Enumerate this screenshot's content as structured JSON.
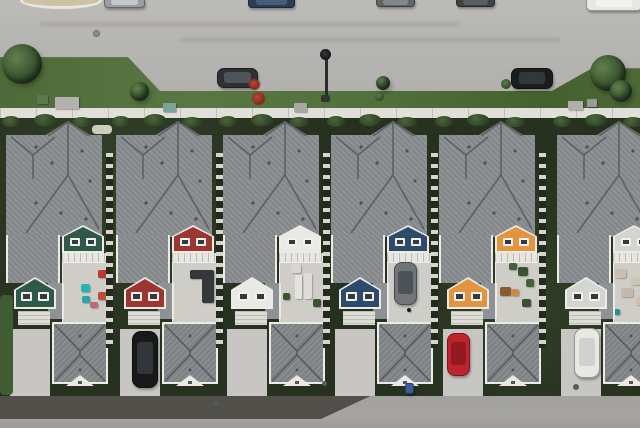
{
  "scene": {
    "description": "Aerial drone photo of six attached townhouses: gray shingle roofs, colored rear gables (green, red, white, blue, orange, gray), rear patios, detached garage roofs, concrete driveways and a back lane at bottom; a curved street with parked cars, grass verge, trees and a sidewalk at top."
  },
  "palette": {
    "street": "#b5b4b1",
    "street_light": "#bcbbb8",
    "sidewalk": "#e0dfda",
    "grass": "#567440",
    "veg": "#27311f",
    "veg_blob": "#2e4026",
    "veg_light": "#4a6638",
    "roof": "#8a8d8f",
    "roof_ridge": "#565a5c",
    "roof_trim": "#ecebe6",
    "garage_roof": "#84878a",
    "patio": "#cfcdc8",
    "deck": "#e7e5e0",
    "driveway": "#c7c6c2",
    "apron": "#c3c2be",
    "lane": "#a6a5a2",
    "lane_dark": "#504f4a",
    "island": "#cdc2a6",
    "window": "#333a3e",
    "win_frame": "#f2f1ed",
    "stone_light": "#d6d5cf",
    "stone_dark": "#222a1c"
  },
  "street": {
    "island": {
      "x": 20,
      "y": -8,
      "w": 82,
      "h": 17
    },
    "manhole": {
      "x": 93,
      "y": 30,
      "d": 7
    },
    "lamp": {
      "head_x": 320,
      "head_y": 49,
      "head_d": 11,
      "pole_x": 325,
      "pole_y": 57,
      "pole_h": 41,
      "base_x": 321,
      "base_y": 95
    },
    "red_shrub": [
      {
        "x": 249,
        "y": 79,
        "d": 11
      },
      {
        "x": 252,
        "y": 92,
        "d": 13
      }
    ],
    "curb_bushes": [
      {
        "x": 501,
        "y": 79,
        "d": 10
      },
      {
        "x": 375,
        "y": 92,
        "d": 9
      }
    ]
  },
  "verge": {
    "trees": [
      {
        "x": 2,
        "y": 44,
        "d": 40
      },
      {
        "x": 130,
        "y": 82,
        "d": 19
      },
      {
        "x": 590,
        "y": 55,
        "d": 36
      },
      {
        "x": 376,
        "y": 76,
        "d": 14
      },
      {
        "x": 610,
        "y": 80,
        "d": 22
      }
    ],
    "boxes": [
      {
        "x": 37,
        "y": 95,
        "w": 11,
        "h": 9,
        "c": "#5a7a4e"
      },
      {
        "x": 55,
        "y": 97,
        "w": 24,
        "h": 12,
        "c": "#b3b2ae"
      },
      {
        "x": 163,
        "y": 103,
        "w": 13,
        "h": 9,
        "c": "#79a49a"
      },
      {
        "x": 294,
        "y": 103,
        "w": 13,
        "h": 9,
        "c": "#a9a8a4"
      },
      {
        "x": 568,
        "y": 101,
        "w": 15,
        "h": 9,
        "c": "#b0afab"
      },
      {
        "x": 587,
        "y": 99,
        "w": 10,
        "h": 8,
        "c": "#9a9995"
      }
    ]
  },
  "houses": [
    {
      "name": "house-1-green",
      "x": 0,
      "facade": "#2e5847",
      "furniture": [
        {
          "x": 18,
          "y": 21,
          "w": 9,
          "h": 8,
          "c": "#2ab4ae"
        },
        {
          "x": 19,
          "y": 33,
          "w": 8,
          "h": 7,
          "c": "#2aa6a8"
        },
        {
          "x": 35,
          "y": 7,
          "w": 10,
          "h": 8,
          "c": "#b83a30"
        },
        {
          "x": 35,
          "y": 29,
          "w": 9,
          "h": 8,
          "c": "#bf4a40"
        },
        {
          "x": 27,
          "y": 39,
          "w": 8,
          "h": 6,
          "c": "#c06a70"
        }
      ],
      "extras": [
        {
          "x": 92,
          "y": 12,
          "w": 20,
          "h": 9,
          "c": "#c9cfbc"
        },
        {
          "x": 0,
          "y": 182,
          "w": 13,
          "h": 100,
          "c": "#3f5c32"
        }
      ]
    },
    {
      "name": "house-2-red",
      "x": 110,
      "facade": "#9c3631",
      "furniture": [
        {
          "x": 17,
          "y": 7,
          "w": 24,
          "h": 9,
          "c": "#35383a"
        },
        {
          "x": 29,
          "y": 14,
          "w": 12,
          "h": 26,
          "c": "#35383a"
        }
      ],
      "extras": []
    },
    {
      "name": "house-3-white",
      "x": 217,
      "facade": "#e9e9e5",
      "furniture": [
        {
          "x": 15,
          "y": 12,
          "w": 7,
          "h": 24,
          "c": "#e4e3de"
        },
        {
          "x": 24,
          "y": 10,
          "w": 8,
          "h": 26,
          "c": "#dddcd7"
        },
        {
          "x": 11,
          "y": 1,
          "w": 10,
          "h": 9,
          "c": "#d8d7d2"
        },
        {
          "x": 33,
          "y": 36,
          "w": 8,
          "h": 8,
          "c": "#3c5531"
        },
        {
          "x": 3,
          "y": 30,
          "w": 7,
          "h": 7,
          "c": "#3c5531"
        }
      ],
      "extras": []
    },
    {
      "name": "house-4-blue",
      "x": 325,
      "facade": "#2c4a69",
      "furniture": [
        {
          "x": 19,
          "y": 45,
          "w": 4,
          "h": 4,
          "c": "#1c1c1c"
        }
      ],
      "extras": []
    },
    {
      "name": "house-5-orange",
      "x": 433,
      "facade": "#e2943f",
      "furniture": [
        {
          "x": 22,
          "y": 4,
          "w": 10,
          "h": 9,
          "c": "#3b5230"
        },
        {
          "x": 13,
          "y": 0,
          "w": 8,
          "h": 7,
          "c": "#44603a"
        },
        {
          "x": 4,
          "y": 24,
          "w": 11,
          "h": 9,
          "c": "#8a5a34"
        },
        {
          "x": 15,
          "y": 26,
          "w": 8,
          "h": 7,
          "c": "#c88c4a"
        },
        {
          "x": 26,
          "y": 36,
          "w": 9,
          "h": 8,
          "c": "#3b5230"
        },
        {
          "x": 30,
          "y": 16,
          "w": 8,
          "h": 8,
          "c": "#44603a"
        }
      ],
      "extras": []
    },
    {
      "name": "house-6-gray",
      "x": 551,
      "facade": "#d3d5d1",
      "last": true,
      "furniture": [
        {
          "x": 1,
          "y": 6,
          "w": 11,
          "h": 9,
          "c": "#c9bfae"
        },
        {
          "x": 7,
          "y": 25,
          "w": 12,
          "h": 9,
          "c": "#c4baa9"
        },
        {
          "x": 17,
          "y": 14,
          "w": 9,
          "h": 8,
          "c": "#cfc5b4"
        },
        {
          "x": 0,
          "y": 46,
          "w": 6,
          "h": 6,
          "c": "#2e8d95"
        },
        {
          "x": 22,
          "y": 34,
          "w": 9,
          "h": 8,
          "c": "#c9bfae"
        }
      ],
      "extras": []
    }
  ],
  "vehicles": [
    {
      "name": "car-top-silver",
      "x": 104,
      "y": -3,
      "w": 41,
      "h": 11,
      "c": "#9aa0a2",
      "roof": "#c7cbcc"
    },
    {
      "name": "car-top-blue",
      "x": 248,
      "y": -4,
      "w": 47,
      "h": 12,
      "c": "#2c3e53",
      "roof": "#46607c"
    },
    {
      "name": "car-top-gray",
      "x": 376,
      "y": -3,
      "w": 39,
      "h": 10,
      "c": "#606568",
      "roof": "#83898c"
    },
    {
      "name": "car-top-dark",
      "x": 456,
      "y": -3,
      "w": 39,
      "h": 10,
      "c": "#3e4345",
      "roof": "#5b6163"
    },
    {
      "name": "vehicle-top-white",
      "x": 586,
      "y": -4,
      "w": 56,
      "h": 15,
      "c": "#e7e7e3",
      "roof": "#f2f2ee"
    },
    {
      "name": "parked-car-left",
      "x": 217,
      "y": 68,
      "w": 41,
      "h": 20,
      "c": "#2d3133",
      "roof": "#50565a"
    },
    {
      "name": "parked-car-right",
      "x": 511,
      "y": 68,
      "w": 42,
      "h": 21,
      "c": "#1b1d1e",
      "roof": "#34393b"
    },
    {
      "name": "suv-black-driveway",
      "x": 132,
      "y": 331,
      "w": 26,
      "h": 57,
      "c": "#17191a",
      "roof": "#34383a"
    },
    {
      "name": "car-gray-parking-pad",
      "x": 394,
      "y": 262,
      "w": 23,
      "h": 43,
      "c": "#70757a",
      "roof": "#4b5054"
    },
    {
      "name": "car-red-driveway",
      "x": 447,
      "y": 333,
      "w": 23,
      "h": 43,
      "c": "#bf232b",
      "roof": "#911a21"
    },
    {
      "name": "van-white-driveway",
      "x": 574,
      "y": 328,
      "w": 26,
      "h": 50,
      "c": "#e8e9e5",
      "roof": "#d0d1cd"
    },
    {
      "name": "bin-blue",
      "x": 405,
      "y": 383,
      "w": 9,
      "h": 11,
      "c": "#3b5e9b"
    }
  ],
  "lane_marks": [
    {
      "x": 322,
      "y": 381,
      "d": 5
    },
    {
      "x": 573,
      "y": 384,
      "d": 6
    },
    {
      "x": 214,
      "y": 401,
      "d": 4
    }
  ]
}
